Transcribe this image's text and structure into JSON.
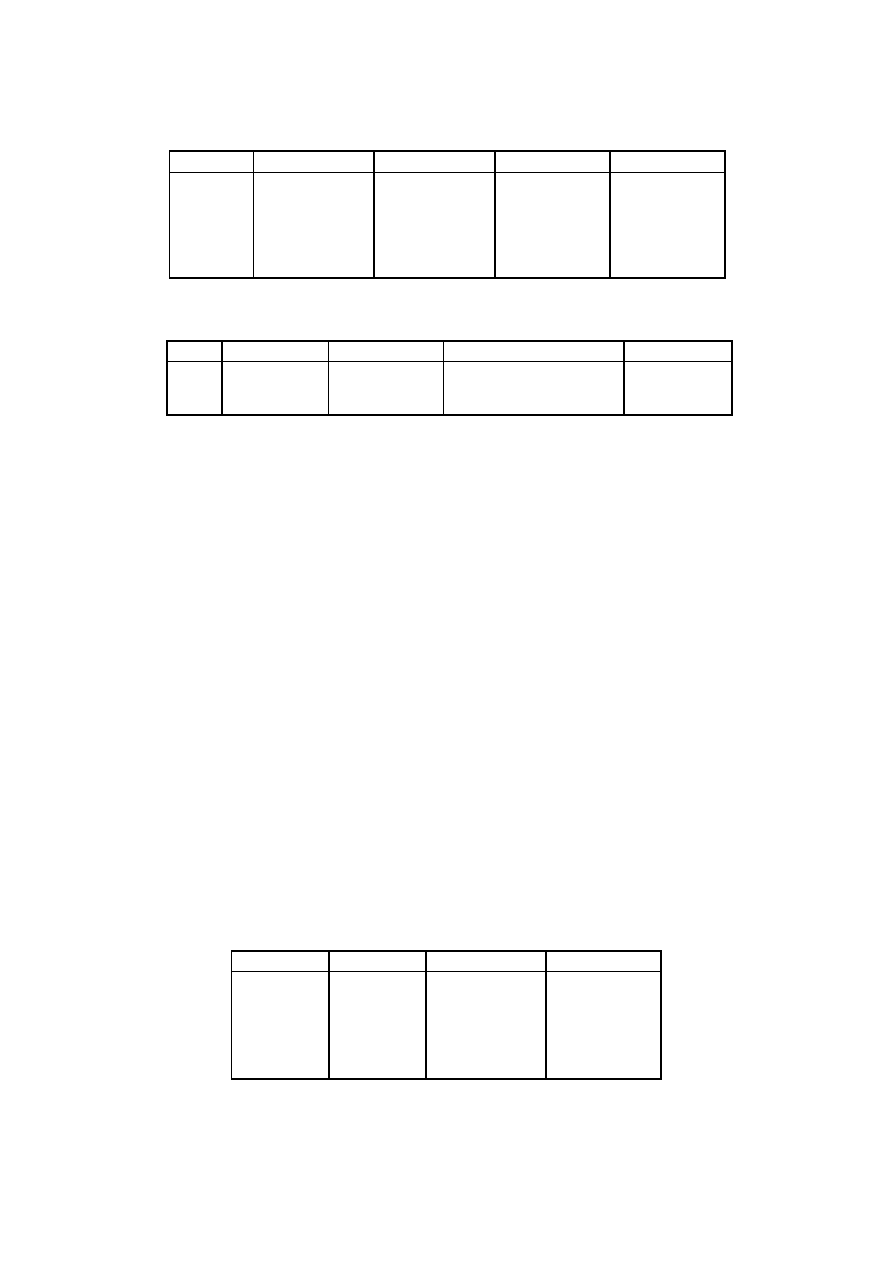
{
  "page": {
    "background": "#ffffff",
    "rule_color": "#000000"
  },
  "tables": [
    {
      "name": "table-1",
      "columns": 5,
      "header": [
        "",
        "",
        "",
        "",
        ""
      ],
      "rows": [
        [
          "",
          "",
          "",
          "",
          ""
        ]
      ]
    },
    {
      "name": "table-2",
      "columns": 5,
      "header": [
        "",
        "",
        "",
        "",
        ""
      ],
      "rows": [
        [
          "",
          "",
          "",
          "",
          ""
        ]
      ]
    },
    {
      "name": "table-3",
      "columns": 4,
      "header": [
        "",
        "",
        "",
        ""
      ],
      "rows": [
        [
          "",
          "",
          "",
          ""
        ]
      ]
    }
  ]
}
